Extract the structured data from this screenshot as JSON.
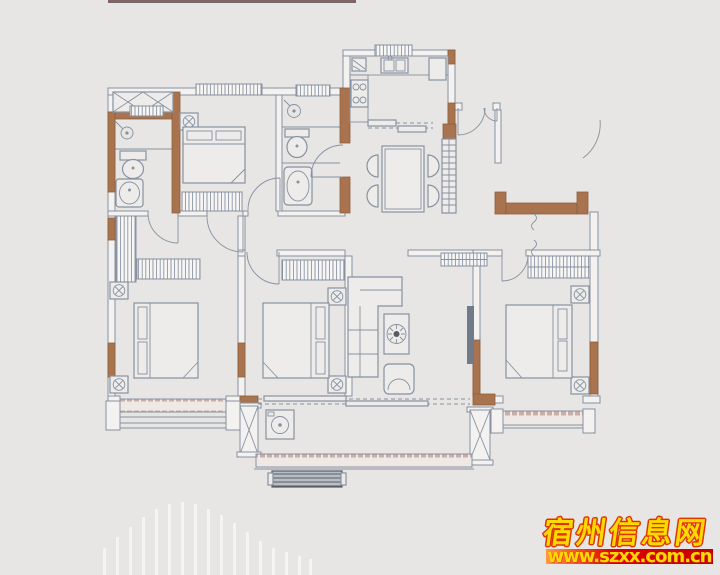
{
  "watermark": {
    "site_name": "宿州信息网",
    "site_url": "www.szxx.com.cn"
  },
  "colors": {
    "bg": "#e7e6e4",
    "line": "#8791a0",
    "wall-brown": "#a8734e",
    "wall-brown-edge": "#8f5f3e",
    "sill-pink": "#c9ada6",
    "bench-dark": "#565c66",
    "wm-yellow": "#ffd900",
    "wm-red": "#e03400",
    "wm-bar-left": "#ff9a40",
    "wm-bar-mid": "#e00000",
    "wm-bar-right": "#c40000",
    "top-line": "#6a4f4e",
    "deco-bar": "#ffffff"
  }
}
